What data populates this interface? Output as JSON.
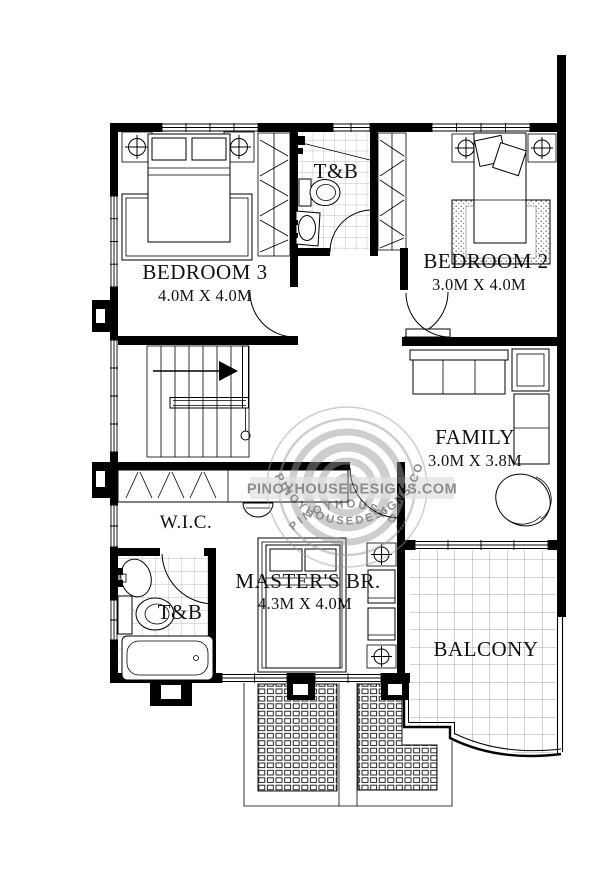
{
  "rooms": {
    "bedroom3": {
      "name": "BEDROOM 3",
      "dims": "4.0M X 4.0M"
    },
    "tnb_top": {
      "name": "T&B"
    },
    "bedroom2": {
      "name": "BEDROOM 2",
      "dims": "3.0M X 4.0M"
    },
    "family": {
      "name": "FAMILY",
      "dims": "3.0M X 3.8M"
    },
    "wic": {
      "name": "W.I.C."
    },
    "tnb_master": {
      "name": "T&B"
    },
    "master": {
      "name": "MASTER'S BR.",
      "dims": "4.3M X 4.0M"
    },
    "balcony": {
      "name": "BALCONY"
    }
  },
  "watermark": {
    "text": "PINOYHOUSEDESIGNS.COM",
    "color": "#9b9b9b"
  },
  "drawing": {
    "ink": "#000000",
    "tile_line": "#a8a8a8"
  }
}
